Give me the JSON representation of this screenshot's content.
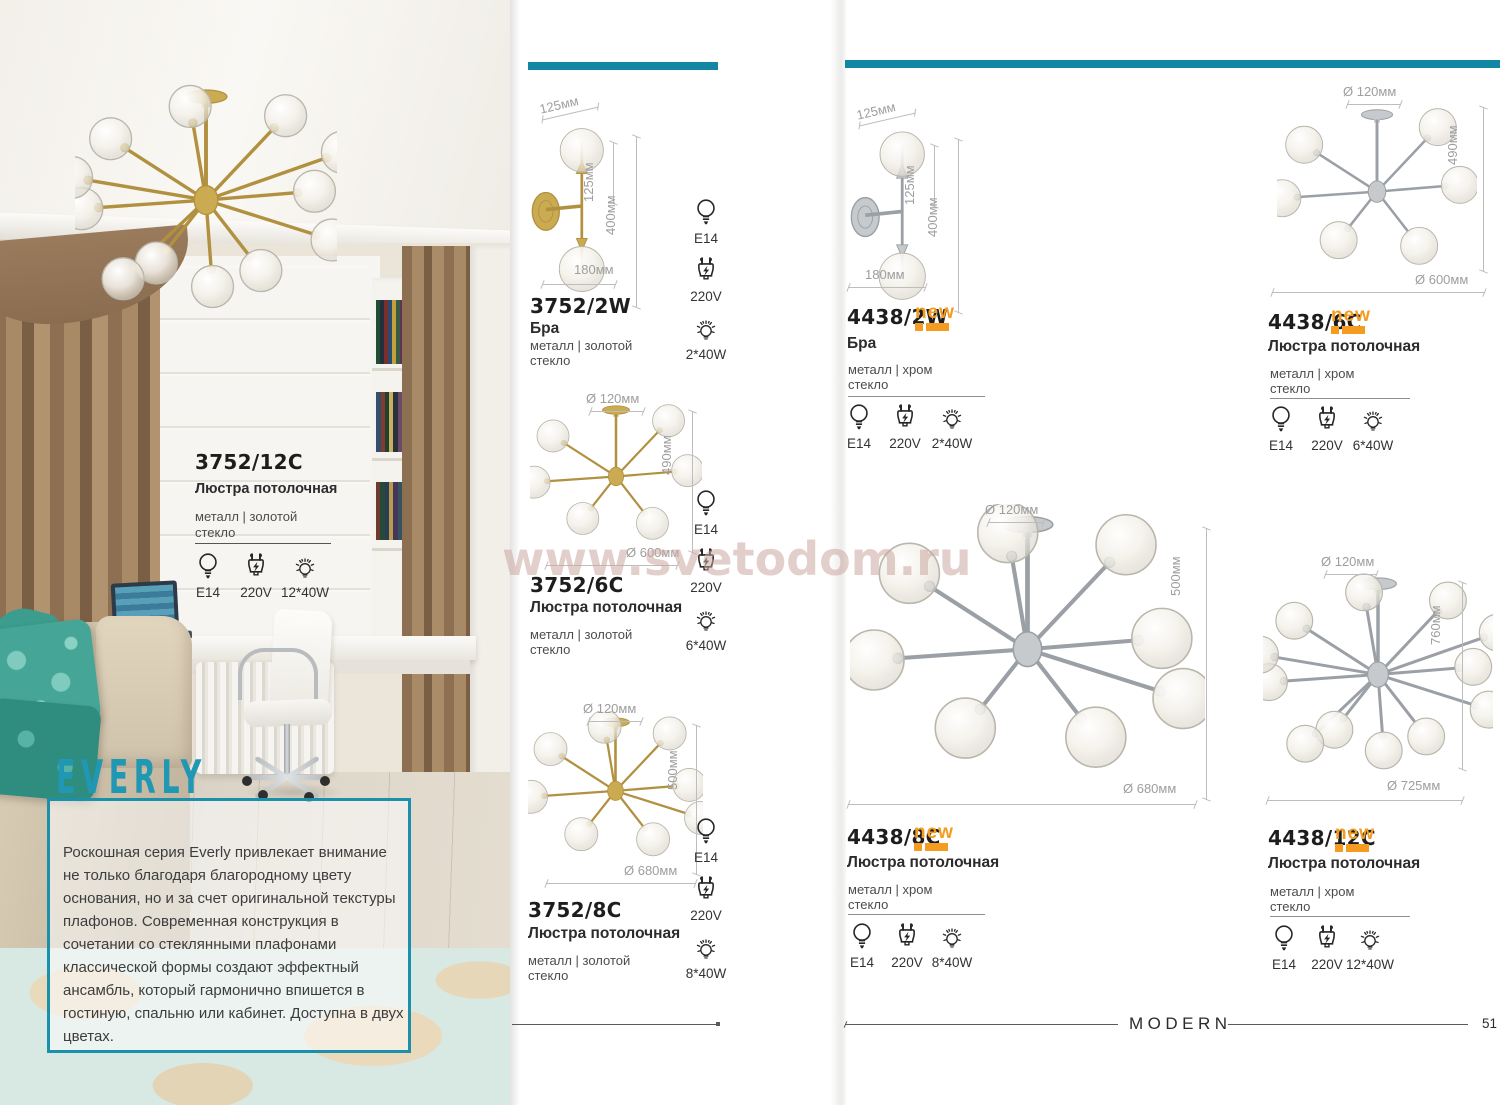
{
  "page": {
    "watermark": "www.svetodom.ru",
    "footer": {
      "category": "MODERN",
      "page_number": "51"
    },
    "series": {
      "name": "EVERLY",
      "description": "Роскошная серия Everly привлекает внимание не только благодаря благородному цвету основания, но и за счет оригинальной текстуры плафонов. Современная конструкция в сочетании со стеклянными плафонами классической формы создают эффектный ансамбль, который гармонично впишется в гостиную, спальню или кабинет. Доступна в двух цветах."
    },
    "colors": {
      "accent_teal": "#1187a3",
      "badge_orange": "#f39c1f",
      "gold": "#b49245",
      "chrome": "#9aa0a6"
    }
  },
  "featured": {
    "code": "3752/12C",
    "type": "Люстра потолочная",
    "material": "металл | золотой",
    "material2": "стекло",
    "lamp": "E14",
    "voltage": "220V",
    "power": "12*40W"
  },
  "products": [
    {
      "code": "3752/2W",
      "badge": "",
      "type": "Бра",
      "material": "металл | золотой",
      "material2": "стекло",
      "lamp": "E14",
      "voltage": "220V",
      "power": "2*40W",
      "dims": {
        "top": "125мм",
        "side1": "125мм",
        "side2": "400мм",
        "bottom": "180мм"
      }
    },
    {
      "code": "3752/6C",
      "badge": "",
      "type": "Люстра потолочная",
      "material": "металл | золотой",
      "material2": "стекло",
      "lamp": "E14",
      "voltage": "220V",
      "power": "6*40W",
      "dims": {
        "top": "Ø 120мм",
        "side": "490мм",
        "bottom": "Ø 600мм"
      }
    },
    {
      "code": "3752/8C",
      "badge": "",
      "type": "Люстра потолочная",
      "material": "металл | золотой",
      "material2": "стекло",
      "lamp": "E14",
      "voltage": "220V",
      "power": "8*40W",
      "dims": {
        "top": "Ø 120мм",
        "side": "500мм",
        "bottom": "Ø 680мм"
      }
    },
    {
      "code": "4438/2W",
      "badge": "new",
      "type": "Бра",
      "material": "металл | хром",
      "material2": "стекло",
      "lamp": "E14",
      "voltage": "220V",
      "power": "2*40W",
      "dims": {
        "top": "125мм",
        "side1": "125мм",
        "side2": "400мм",
        "bottom": "180мм"
      }
    },
    {
      "code": "4438/6C",
      "badge": "new",
      "type": "Люстра потолочная",
      "material": "металл | хром",
      "material2": "стекло",
      "lamp": "E14",
      "voltage": "220V",
      "power": "6*40W",
      "dims": {
        "top": "Ø 120мм",
        "side": "490мм",
        "bottom": "Ø 600мм"
      }
    },
    {
      "code": "4438/8C",
      "badge": "new",
      "type": "Люстра потолочная",
      "material": "металл | хром",
      "material2": "стекло",
      "lamp": "E14",
      "voltage": "220V",
      "power": "8*40W",
      "dims": {
        "top": "Ø 120мм",
        "side": "500мм",
        "bottom": "Ø 680мм"
      }
    },
    {
      "code": "4438/12C",
      "badge": "new",
      "type": "Люстра потолочная",
      "material": "металл | хром",
      "material2": "стекло",
      "lamp": "E14",
      "voltage": "220V",
      "power": "12*40W",
      "dims": {
        "top": "Ø 120мм",
        "side": "760мм",
        "bottom": "Ø 725мм"
      }
    }
  ]
}
